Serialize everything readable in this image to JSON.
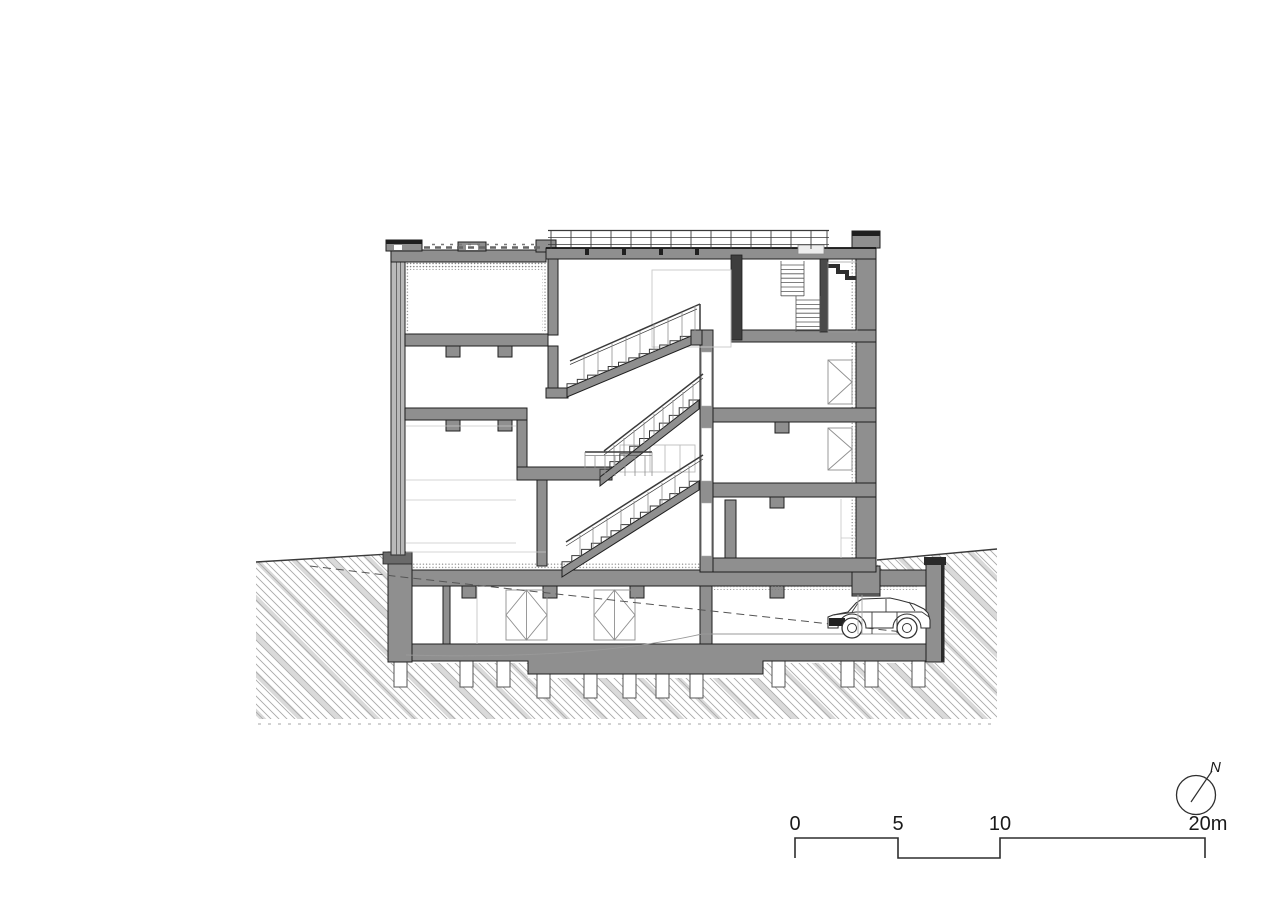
{
  "drawing": {
    "kind": "architectural cross-section",
    "content": "building section with switchback stair, roof terrace railing, green roof, basement parking garage with car, hatched earth and foundation piles"
  },
  "colors": {
    "line": "#3a3a3a",
    "line_dark": "#1f1f1f",
    "poche": "#8f8f8f",
    "wall_dark": "#3d3d3d",
    "hatch": "#a9a9a9",
    "hatch_band": "#dadada",
    "light_line": "#c6c6c6",
    "text": "#1a1a1a",
    "background": "#ffffff"
  },
  "scale_bar": {
    "labels": [
      "0",
      "5",
      "10",
      "20m"
    ],
    "unit": "m"
  },
  "north_arrow": {
    "label": "N"
  }
}
